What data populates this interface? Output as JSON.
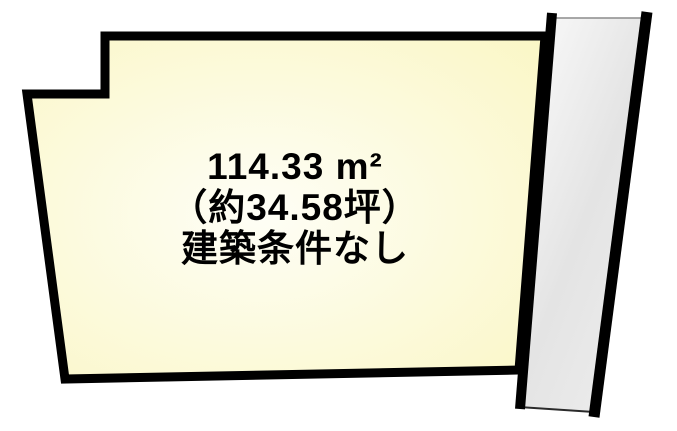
{
  "diagram": {
    "type": "land-plot-layout",
    "background_color": "#FFFFFF",
    "plot": {
      "area_label": "114.33 m²",
      "tsubo_label": "（約34.58坪）",
      "condition_label": "建築条件なし",
      "fill_center_color": "#FEFEF6",
      "fill_edge_color": "#FAF6C2",
      "border_color": "#000000",
      "text_color": "#000000"
    },
    "road": {
      "fill_light_color": "#FCFCFC",
      "fill_dark_color": "#E4E4E4",
      "border_color": "#000000",
      "top_edge_color": "#8C8C8C",
      "bottom_edge_color": "#2A2A2A"
    }
  }
}
